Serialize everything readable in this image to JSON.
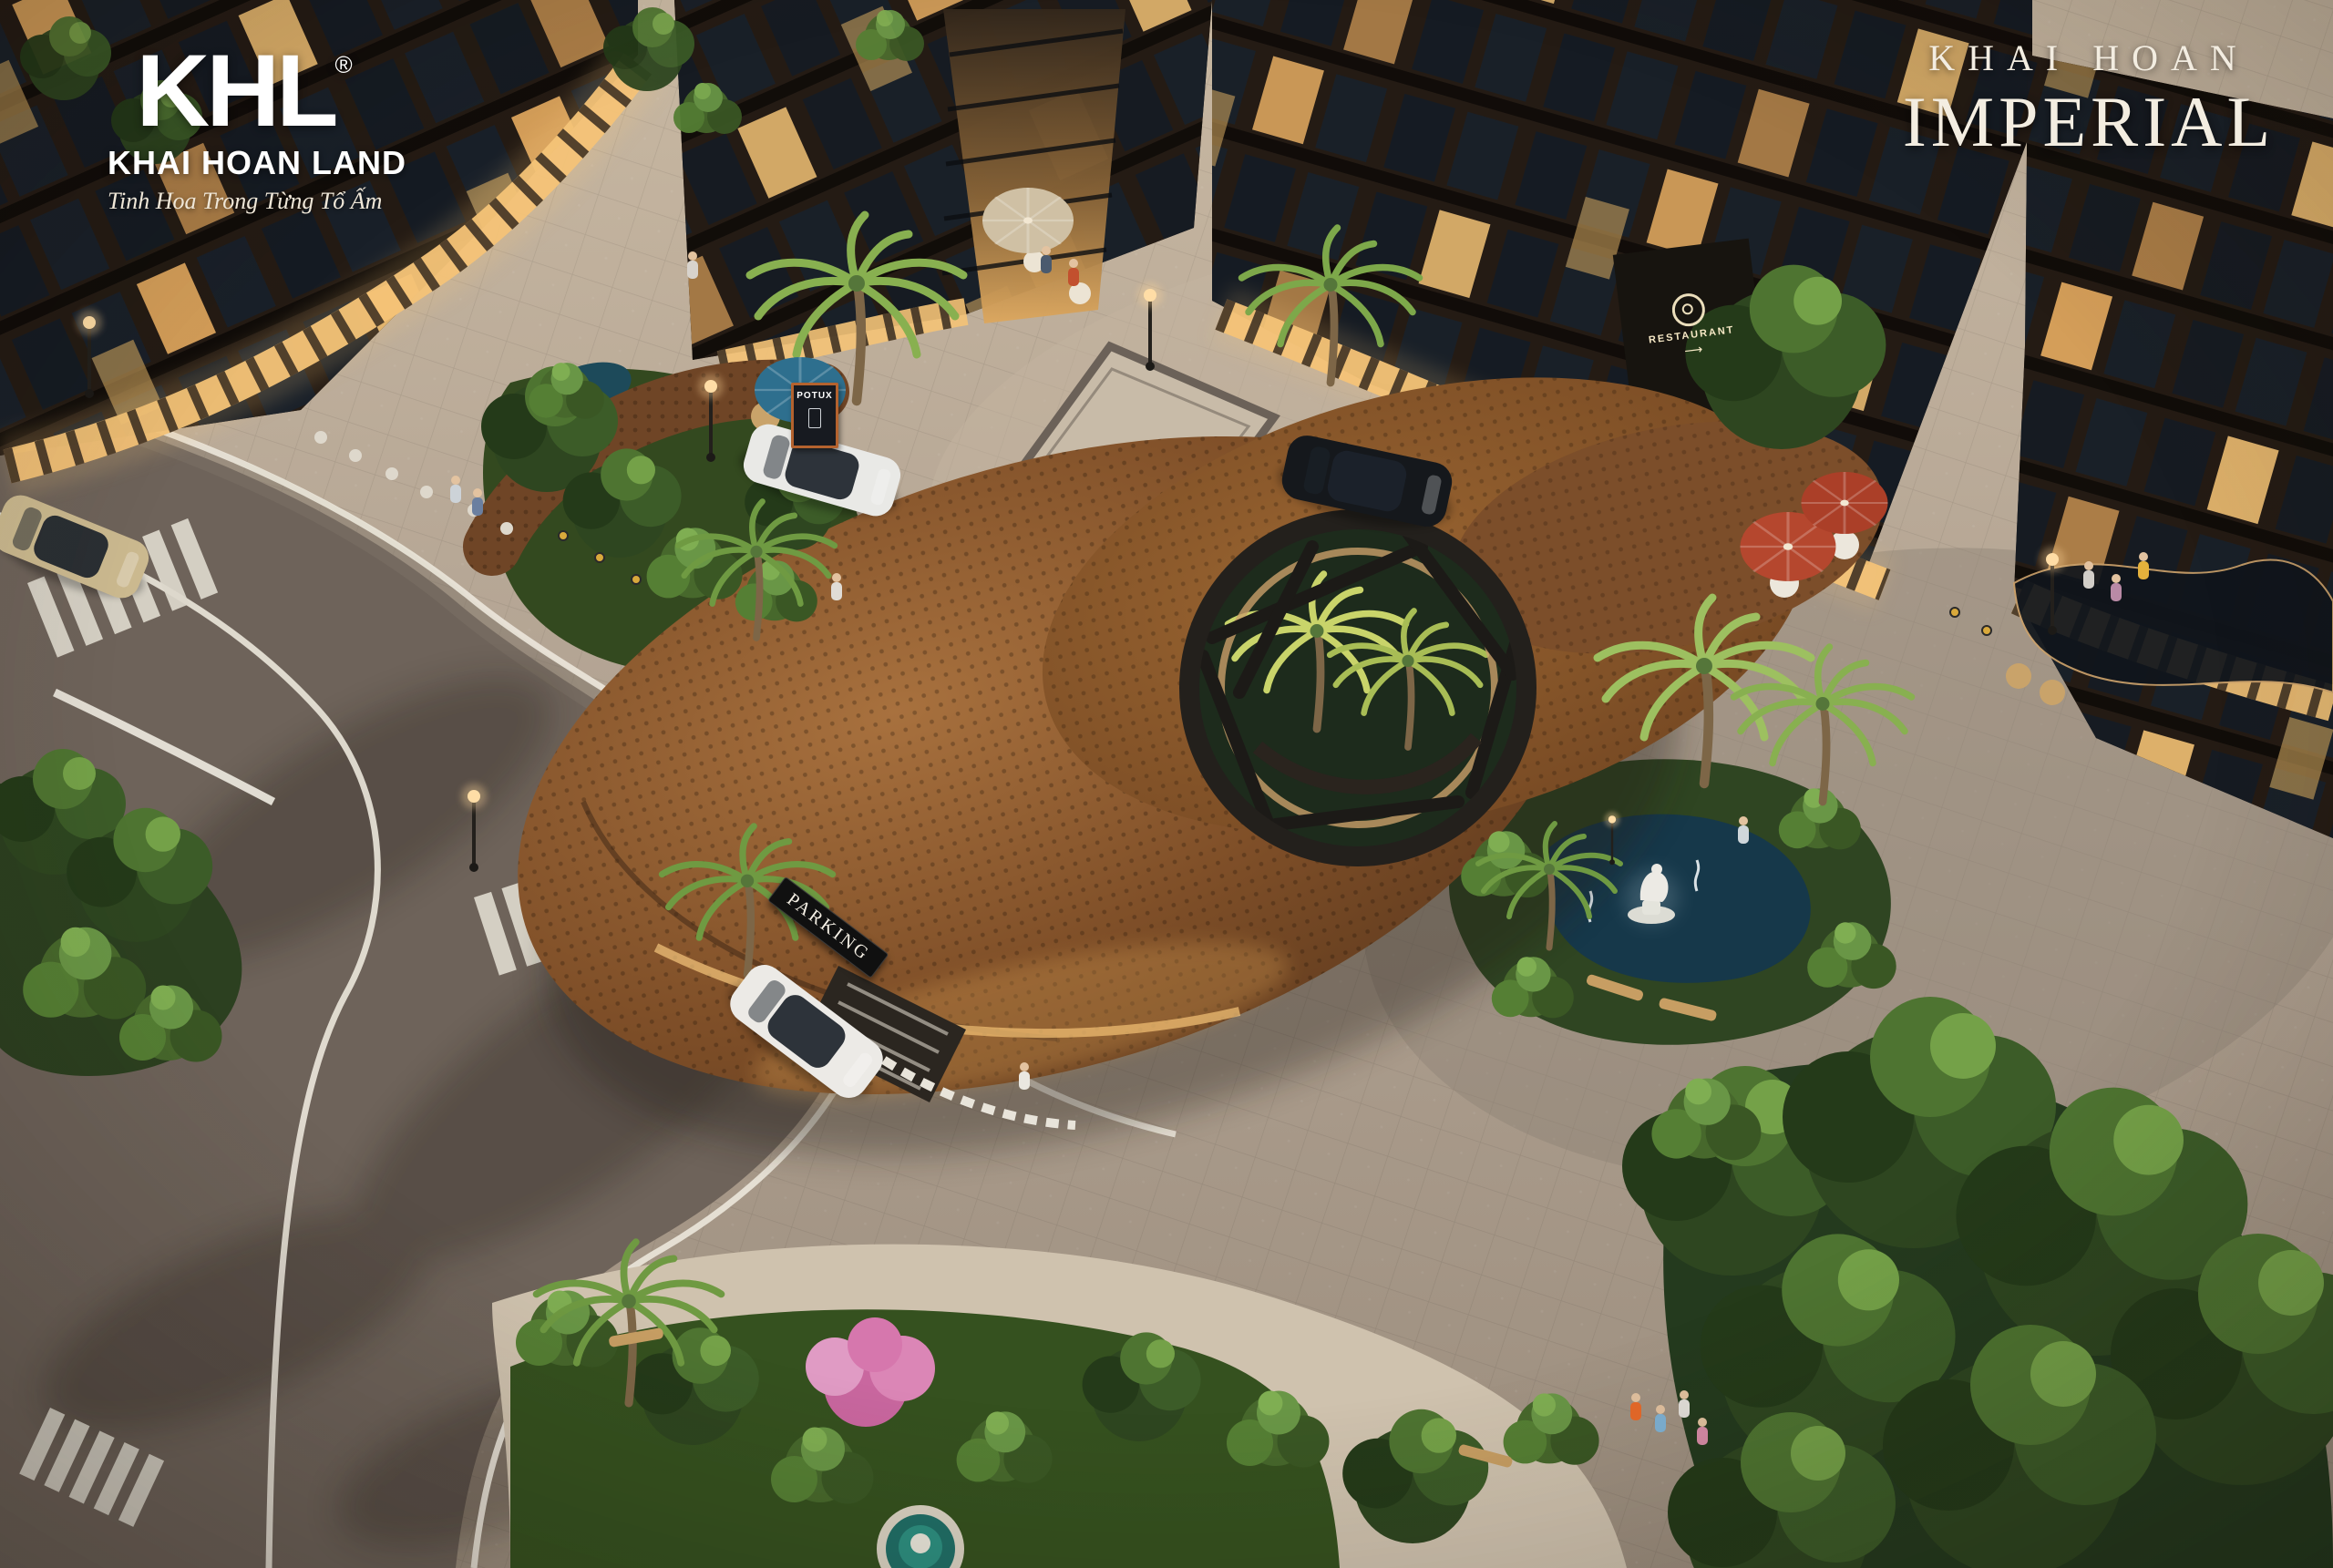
{
  "branding": {
    "logo_monogram": "KHL",
    "logo_registered": "®",
    "logo_name": "KHAI HOAN LAND",
    "logo_tagline": "Tinh Hoa Trong Từng Tổ Ấm"
  },
  "project": {
    "name_line1": "KHAI HOAN",
    "name_line2": "IMPERIAL"
  },
  "signs": {
    "parking": "PARKING",
    "restaurant": "RESTAURANT",
    "restaurant_arrow": "⟶",
    "cafe_board": "POTUX"
  },
  "palette": {
    "facade_brown": "#2b211a",
    "window_glow": "#e8ae63",
    "canopy_copper": "#8a5a33",
    "asphalt": "#6e635a",
    "paver": "#b4a795",
    "water_teal": "#1e3f52",
    "foliage_green": "#3f5b31",
    "umbrella_red": "#b5472e",
    "umbrella_blue": "#2e6f8e",
    "logo_white": "#ffffff"
  }
}
